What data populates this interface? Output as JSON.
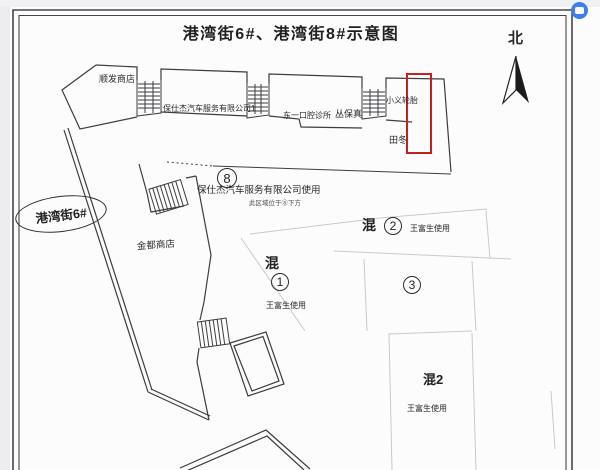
{
  "title": "港湾街6#、港湾街8#示意图",
  "compass": {
    "label": "北"
  },
  "street": {
    "label": "港湾街6#"
  },
  "top_row": {
    "shunfa": "顺发商店",
    "baoshijie1": "保仕杰汽车服务有限公司1",
    "dental": "东一口腔诊所",
    "congbaozhen": "丛保真",
    "xiaoyi_tire": "小义轮胎",
    "tiandong": "田冬"
  },
  "center": {
    "circle8": "8",
    "baoshijie_use": "保仕杰汽车服务有限公司使用",
    "note_under_8": "此区域位于⑧下方",
    "jindu": "金都商店"
  },
  "units": {
    "hun1_prefix": "混",
    "hun1_num": "1",
    "hun1_user": "王富生使用",
    "hun2_prefix": "混",
    "hun2_num": "2",
    "hun2_user": "王富生使用",
    "num3": "3",
    "hun2b_label": "混2",
    "hun2b_user": "王富生使用"
  },
  "colors": {
    "highlight_box": "#c4201d",
    "line": "#3d3d40",
    "faint_line": "#c9c9cd",
    "badge_blue": "#3e7ef0"
  }
}
